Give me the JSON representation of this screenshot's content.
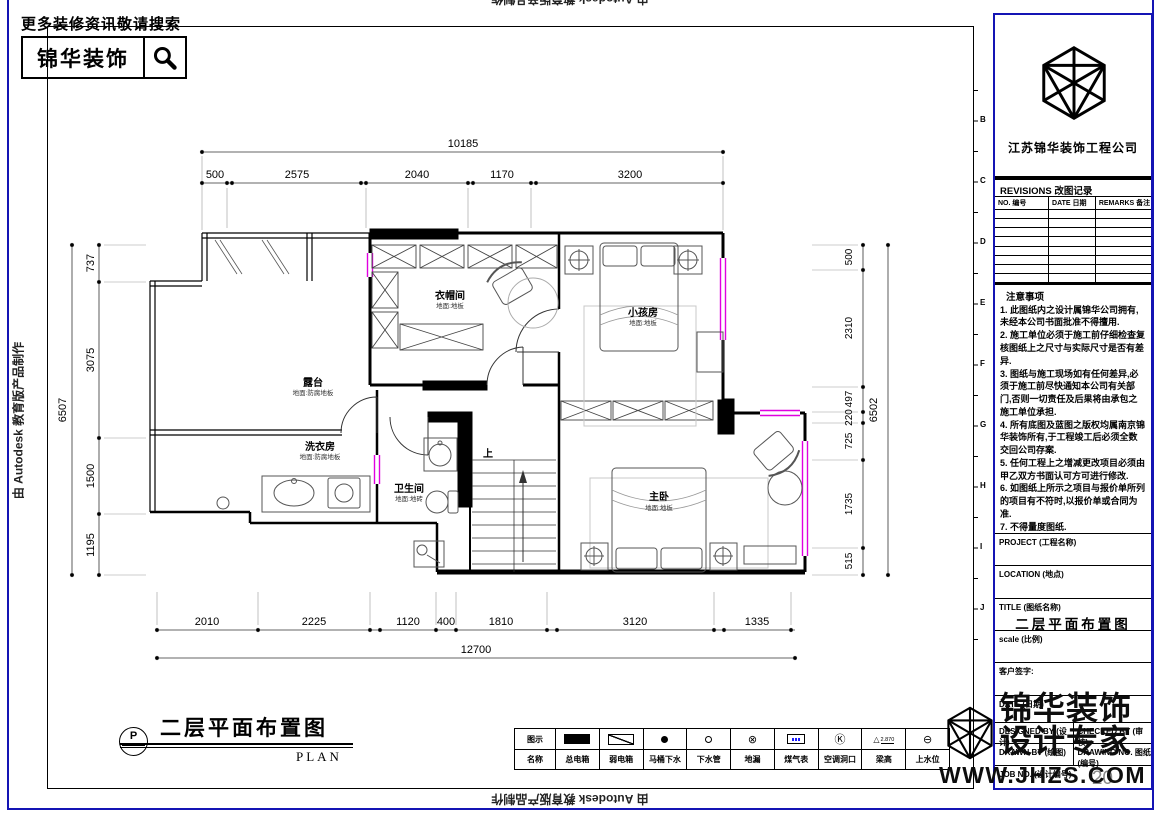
{
  "banner": {
    "tagline": "更多装修资讯敬请搜索",
    "brand": "锦华装饰"
  },
  "autodesk_credit": "由 Autodesk 教育版产品制作",
  "plan": {
    "title": "二层平面布置图",
    "title_en": "PLAN",
    "marker": "P",
    "stairs_up_label": "上",
    "rooms": [
      {
        "name": "衣帽间",
        "floor": "地面:地板"
      },
      {
        "name": "小孩房",
        "floor": "地面:地板"
      },
      {
        "name": "露台",
        "floor": "地面:防腐地板"
      },
      {
        "name": "洗衣房",
        "floor": "地面:防腐地板"
      },
      {
        "name": "卫生间",
        "floor": "地面:地砖"
      },
      {
        "name": "主卧",
        "floor": "地面:地板"
      }
    ]
  },
  "dims": {
    "top_total": "10185",
    "top_segments": [
      "500",
      "2575",
      "2040",
      "1170",
      "3200"
    ],
    "left_total": "6507",
    "left_segments": [
      "737",
      "3075",
      "1500",
      "1195"
    ],
    "right_total": "6502",
    "right_segments": [
      "500",
      "2310",
      "497",
      "220",
      "725",
      "1735",
      "515"
    ],
    "bottom_total": "12700",
    "bottom_segments": [
      "2010",
      "2225",
      "1120",
      "400",
      "1810",
      "3120",
      "1335"
    ]
  },
  "legend": {
    "row_icon_header": "图示",
    "row_name_header": "名称",
    "items": [
      {
        "label": "总电箱"
      },
      {
        "label": "弱电箱"
      },
      {
        "label": "马桶下水"
      },
      {
        "label": "下水管"
      },
      {
        "label": "地漏",
        "glyph": "⊗"
      },
      {
        "label": "煤气表"
      },
      {
        "label": "空调洞口",
        "glyph": "Ⓚ"
      },
      {
        "label": "梁高",
        "glyph": "△",
        "value": "2.870"
      },
      {
        "label": "上水位",
        "glyph": "⊖"
      }
    ]
  },
  "titleblock": {
    "company": "江苏锦华装饰工程公司",
    "revisions_title": "REVISIONS 改图记录",
    "rev_cols": [
      "NO. 编号",
      "DATE 日期",
      "REMARKS 备注"
    ],
    "notes_title": "注意事项",
    "notes": [
      "1. 此图纸内之设计属锦华公司拥有,未经本公司书面批准不得擅用.",
      "2. 施工单位必须于施工前仔细检查复核图纸上之尺寸与实际尺寸是否有差异.",
      "3. 图纸与施工现场如有任何差异,必须于施工前尽快通知本公司有关部门,否则一切责任及后果将由承包之施工单位承担.",
      "4. 所有底图及蓝图之版权均属南京锦华装饰所有,于工程竣工后必须全数交回公司存案.",
      "5. 任何工程上之增减更改项目必须由甲乙双方书面认可方可进行修改.",
      "6. 如图纸上所示之项目与报价单所列的项目有不符时,以报价单或合同为准.",
      "7. 不得量度图纸."
    ],
    "project_label": "PROJECT (工程名称)",
    "location_label": "LOCATION (地点)",
    "title_label": "TITLE (图纸名称)",
    "drawing_title": "二层平面布置图",
    "scale_label": "scale (比例)",
    "client_sign_label": "客户签字:",
    "date_label": "DATE (日期)",
    "designed_label": "DESIGNED BY (设计)",
    "checked_label": "CHECKED BY (审核)",
    "drawn_label": "DRAWN BY (绘图)",
    "drawing_no_label": "DRAWING NO. 图纸(编号)",
    "job_no_label": "JOB NO. (设计编号)",
    "job_no": "20"
  },
  "brandmark": {
    "line1": "锦华装饰",
    "line2": "设计专家",
    "url": "WWW.JHZS.COM"
  },
  "ruler_letters": [
    "B",
    "C",
    "D",
    "E",
    "F",
    "G",
    "H",
    "I",
    "J"
  ]
}
